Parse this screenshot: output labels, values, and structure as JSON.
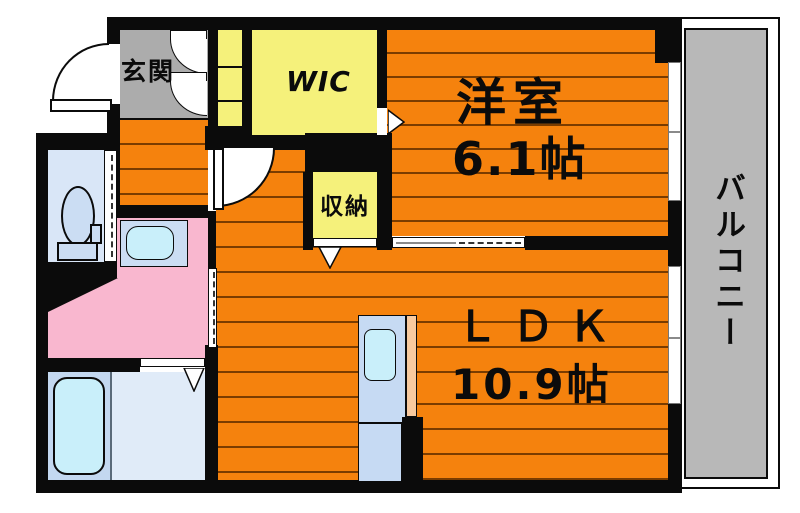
{
  "title": "apartment-floor-plan",
  "rooms": {
    "genkan": {
      "label": "玄関"
    },
    "wic": {
      "label": "WIC"
    },
    "western_room": {
      "label": "洋室",
      "size": "6.1帖"
    },
    "storage": {
      "label": "収納"
    },
    "ldk": {
      "label": "ＬＤＫ",
      "size": "10.9帖"
    },
    "balcony": {
      "label": "バルコニー"
    }
  },
  "colors": {
    "flooring_orange": "#F5820D",
    "plank_line": "#7a3c00",
    "closet_yellow": "#F5F17B",
    "entrance_gray": "#ACACAC",
    "balcony_gray": "#B8B8B8",
    "washroom_pink": "#F9B7CF",
    "toilet_room_blue": "#D9E6F7",
    "fixture_blue": "#CBDDF3",
    "water_cyan": "#C9EFFA",
    "bath_floor_blue": "#E0EBF8",
    "counter_peach": "#F8CA9F",
    "wall_black": "#0B0B0B"
  }
}
